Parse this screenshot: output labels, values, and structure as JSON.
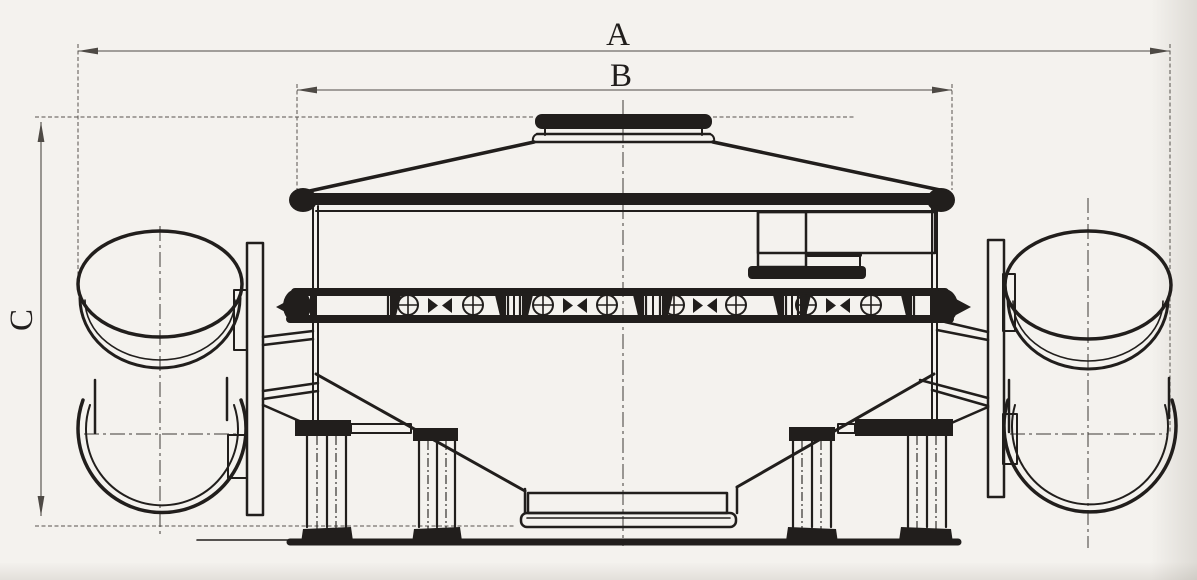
{
  "diagram": {
    "type": "technical-dimension-drawing",
    "dimension_labels": {
      "a": "A",
      "b": "B",
      "c": "C"
    },
    "colors": {
      "paper": "#f4f2ee",
      "ink": "#211e1c",
      "dim": "#4e4a45",
      "cl": "#3e3b37"
    }
  }
}
